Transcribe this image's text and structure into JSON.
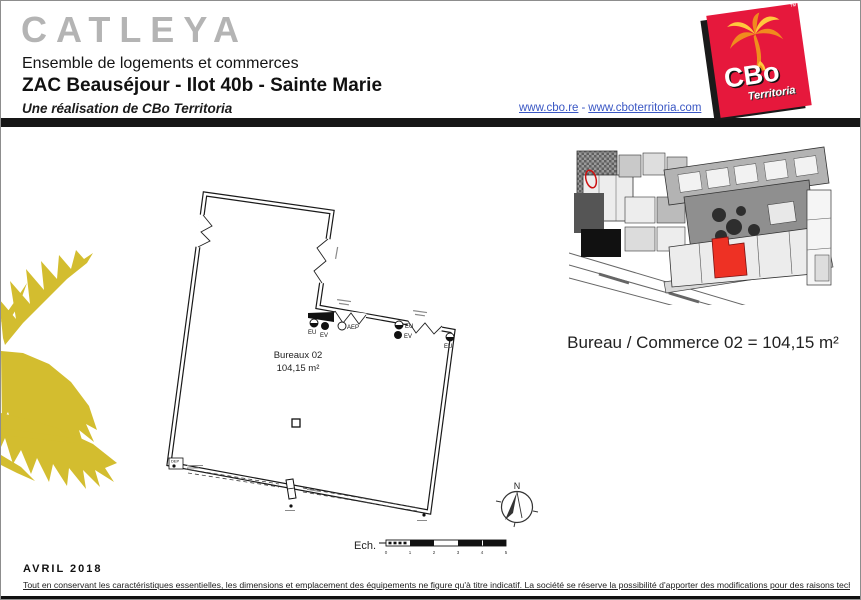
{
  "header": {
    "title": "CATLEYA",
    "subtitle": "Ensemble de logements et commerces",
    "project_line": "ZAC Beauséjour - Ilot 40b - Sainte Marie",
    "byline": "Une réalisation de CBo Territoria",
    "link1": "www.cbo.re",
    "link_separator": "-",
    "link2": "www.cboterritoria.com"
  },
  "logo": {
    "brand": "CBo",
    "brand_sub": "Territoria",
    "trademark": "™",
    "bg_color": "#e6183c"
  },
  "site_plan": {
    "highlight_color": "#ee3124"
  },
  "floor_plan": {
    "room_label": "Bureaux 02",
    "room_area": "104,15 m²",
    "labels": {
      "eu": "EU",
      "ev": "EV",
      "aep": "AEP",
      "dep": "DEP"
    }
  },
  "summary_line": "Bureau / Commerce 02 = 104,15 m²",
  "compass": {
    "north_label": "N"
  },
  "scale_bar": {
    "label": "Ech.",
    "ticks": [
      "0",
      "1",
      "2",
      "3",
      "4",
      "5"
    ]
  },
  "footer": {
    "date": "AVRIL 2018",
    "disclaimer": "Tout en conservant les caractéristiques essentielles, les dimensions et emplacement des équipements ne figure qu'à titre indicatif. La société se réserve la possibilité d'apporter des modifications pour des raisons techniques."
  }
}
